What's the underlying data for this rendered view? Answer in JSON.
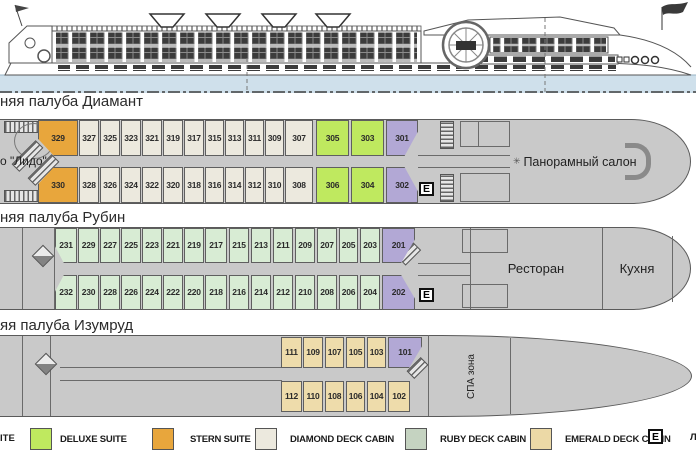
{
  "page": {
    "width": 696,
    "height": 464,
    "background": "#ffffff"
  },
  "ship_profile": {
    "description": "side-view line drawing of river cruise ship",
    "water_color": "#cfe0eb"
  },
  "decks": {
    "diamond": {
      "title": "няя палуба Диамант",
      "lido_label": "о \"Лидо\"",
      "salon_label": "Панорамный салон",
      "elevator_label": "E",
      "top": [
        "329",
        "327",
        "325",
        "323",
        "321",
        "319",
        "317",
        "315",
        "313",
        "311",
        "309",
        "307",
        "305",
        "303",
        "301"
      ],
      "bottom": [
        "330",
        "328",
        "326",
        "324",
        "322",
        "320",
        "318",
        "316",
        "314",
        "312",
        "310",
        "308",
        "306",
        "304",
        "302"
      ]
    },
    "ruby": {
      "title": "няя палуба Рубин",
      "restaurant_label": "Ресторан",
      "kitchen_label": "Кухня",
      "elevator_label": "E",
      "top": [
        "231",
        "229",
        "227",
        "225",
        "223",
        "221",
        "219",
        "217",
        "215",
        "213",
        "211",
        "209",
        "207",
        "205",
        "203",
        "201"
      ],
      "bottom": [
        "232",
        "230",
        "228",
        "226",
        "224",
        "222",
        "220",
        "218",
        "216",
        "214",
        "212",
        "210",
        "208",
        "206",
        "204",
        "202"
      ]
    },
    "emerald": {
      "title": "яя палуба Изумруд",
      "spa_label": "СПА зона",
      "top": [
        "111",
        "109",
        "107",
        "105",
        "103",
        "101"
      ],
      "bottom": [
        "112",
        "110",
        "108",
        "106",
        "104",
        "102"
      ]
    }
  },
  "legend": {
    "partial_first_label": "ITE",
    "items": [
      {
        "label": "DELUXE SUITE",
        "color": "#bfe95f"
      },
      {
        "label": "STERN SUITE",
        "color": "#e8a63c"
      },
      {
        "label": "DIAMOND DECK CABIN",
        "color": "#ece9de"
      },
      {
        "label": "RUBY DECK CABIN",
        "color": "#c5d3c1"
      },
      {
        "label": "EMERALD DECK CABIN",
        "color": "#ecd9a6"
      }
    ],
    "elevator_label": "E",
    "partial_last_label": "Л"
  },
  "colors": {
    "deck_grey": "#c9c9c9",
    "deluxe_suite": "#bfe95f",
    "stern_suite": "#e8a63c",
    "diamond_cabin": "#ece9de",
    "ruby_cabin": "#d8ecd4",
    "emerald_cabin": "#eedcab",
    "suite_purple": "#b2a8d5",
    "water": "#cfe0eb"
  }
}
